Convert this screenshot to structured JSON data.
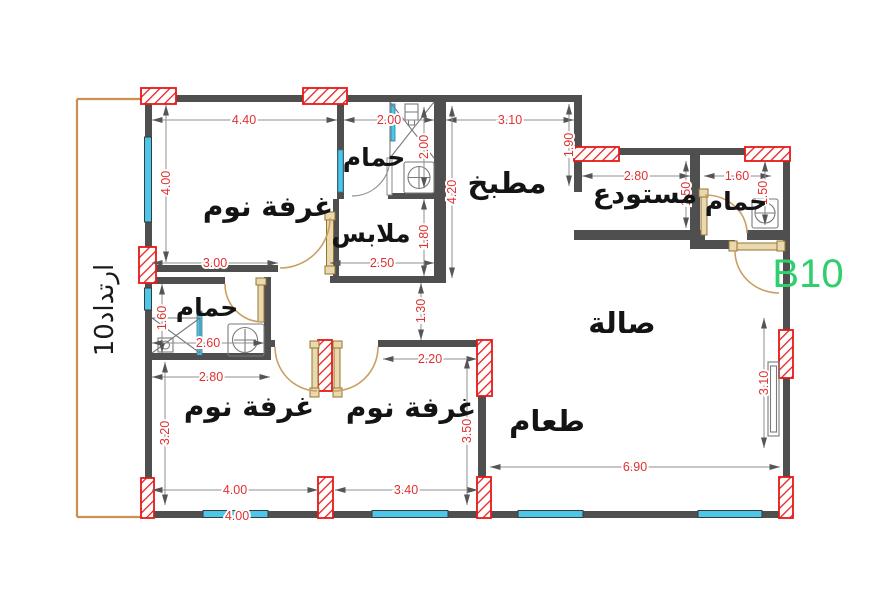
{
  "drawing": {
    "unit_label": "B10",
    "setback_label": "ارتداد10"
  },
  "rooms": [
    {
      "id": "bedroom-1",
      "label": "غرفة نوم"
    },
    {
      "id": "bathroom-top",
      "label": "حمام"
    },
    {
      "id": "closet",
      "label": "ملابس"
    },
    {
      "id": "kitchen",
      "label": "مطبخ"
    },
    {
      "id": "storage",
      "label": "مستودع"
    },
    {
      "id": "bathroom-right",
      "label": "حمام"
    },
    {
      "id": "hall",
      "label": "صالة"
    },
    {
      "id": "bathroom-left",
      "label": "حمام"
    },
    {
      "id": "bedroom-2",
      "label": "غرفة نوم"
    },
    {
      "id": "bedroom-3",
      "label": "غرفة نوم"
    },
    {
      "id": "dining",
      "label": "طعام"
    }
  ],
  "dimensions": [
    {
      "id": "bedroom1-width",
      "value": "4.40"
    },
    {
      "id": "bathroom-top-width",
      "value": "2.00"
    },
    {
      "id": "kitchen-width",
      "value": "3.10"
    },
    {
      "id": "bedroom1-height",
      "value": "4.00"
    },
    {
      "id": "bathroom-top-height",
      "value": "2.00"
    },
    {
      "id": "kitchen-height",
      "value": "4.20"
    },
    {
      "id": "kitchen-right-height",
      "value": "1.90"
    },
    {
      "id": "storage-width",
      "value": "2.80"
    },
    {
      "id": "bathroom-right-width",
      "value": "1.60"
    },
    {
      "id": "storage-height",
      "value": "1.50"
    },
    {
      "id": "bathroom-right-height",
      "value": "1.50"
    },
    {
      "id": "bedroom1-bottom",
      "value": "3.00"
    },
    {
      "id": "closet-width",
      "value": "2.50"
    },
    {
      "id": "closet-height",
      "value": "1.80"
    },
    {
      "id": "corridor-width",
      "value": "1.30"
    },
    {
      "id": "bathroom-left-height",
      "value": "1.60"
    },
    {
      "id": "bathroom-left-width",
      "value": "2.60"
    },
    {
      "id": "bathroom-left-outer",
      "value": "2.80"
    },
    {
      "id": "bedroom2-height",
      "value": "3.20"
    },
    {
      "id": "bedroom3-top",
      "value": "2.20"
    },
    {
      "id": "bedroom3-height",
      "value": "3.50"
    },
    {
      "id": "bedroom2-width",
      "value": "4.00"
    },
    {
      "id": "bedroom3-width",
      "value": "3.40"
    },
    {
      "id": "dining-width",
      "value": "6.90"
    },
    {
      "id": "hall-right-height",
      "value": "3.10"
    },
    {
      "id": "bottom-overall",
      "value": "4.00"
    }
  ],
  "colors": {
    "dimension_text": "#e03131",
    "wall": "#4f4f4f",
    "column_accent": "#e81818",
    "window": "#4cc7ea",
    "door": "#c9a063",
    "unit_label": "#2fcf6e",
    "boundary": "#cc8f4d"
  }
}
